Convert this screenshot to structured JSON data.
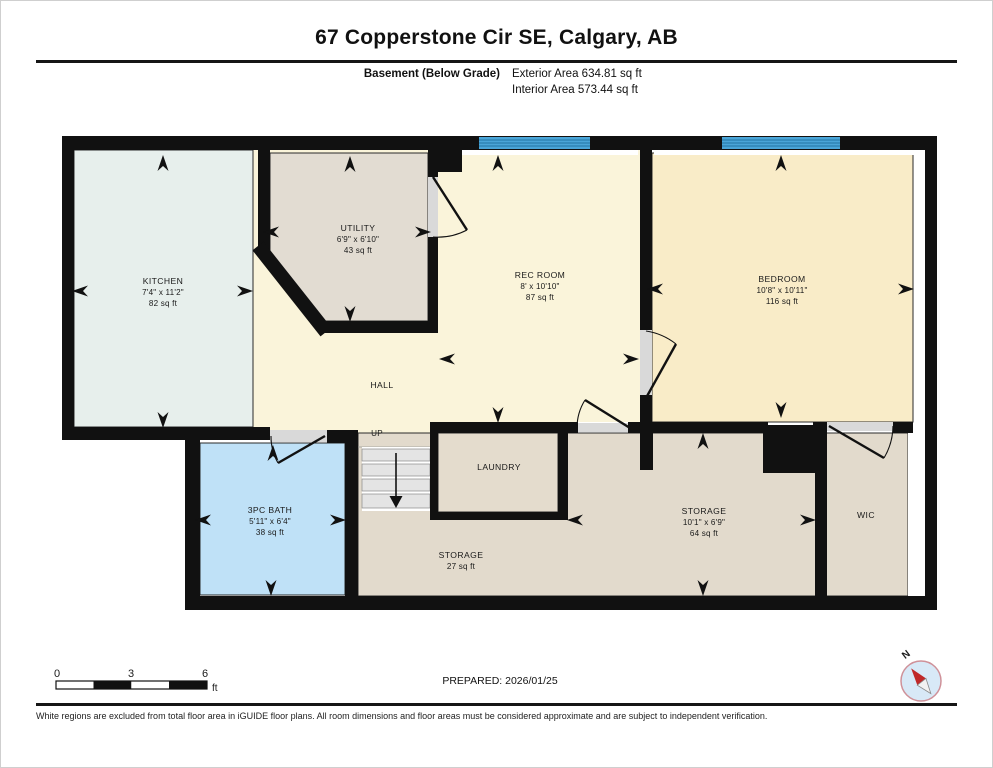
{
  "header": {
    "title": "67 Copperstone Cir SE, Calgary, AB",
    "floor_label": "Basement (Below Grade)",
    "exterior_area": "Exterior Area 634.81 sq ft",
    "interior_area": "Interior Area 573.44 sq ft"
  },
  "rooms": {
    "kitchen": {
      "name": "KITCHEN",
      "dims": "7'4\" x 11'2\"",
      "area": "82 sq ft"
    },
    "utility": {
      "name": "UTILITY",
      "dims": "6'9\" x 6'10\"",
      "area": "43 sq ft"
    },
    "rec_room": {
      "name": "REC ROOM",
      "dims": "8' x 10'10\"",
      "area": "87 sq ft"
    },
    "bedroom": {
      "name": "BEDROOM",
      "dims": "10'8\" x 10'11\"",
      "area": "116 sq ft"
    },
    "hall": {
      "name": "HALL"
    },
    "stairs": {
      "label": "UP"
    },
    "laundry": {
      "name": "LAUNDRY"
    },
    "bath": {
      "name": "3PC BATH",
      "dims": "5'11\" x 6'4\"",
      "area": "38 sq ft"
    },
    "storage_small": {
      "name": "STORAGE",
      "area": "27 sq ft"
    },
    "storage_large": {
      "name": "STORAGE",
      "dims": "10'1\" x 6'9\"",
      "area": "64 sq ft"
    },
    "wic": {
      "name": "WIC"
    }
  },
  "scale_bar": {
    "ticks": [
      "0",
      "3",
      "6"
    ],
    "unit": "ft"
  },
  "compass": {
    "label": "N"
  },
  "footer": {
    "prepared": "PREPARED: 2026/01/25",
    "disclaimer": "White regions are excluded from total floor area in iGUIDE floor plans. All room dimensions and floor areas must be considered approximate and are subject to independent verification."
  },
  "colors": {
    "wall": "#111111",
    "kitchen": "#e7efec",
    "utility": "#e2dcd2",
    "hall": "#faf4da",
    "bedroom": "#f9ecc8",
    "bath": "#bfe1f7",
    "storage": "#e2dacc",
    "laundry": "#e4dccd",
    "stairs": "#e4e4e4",
    "window": "#4aa5d8",
    "window_stripe": "#2b7fae",
    "door_sill": "#d9d9d9",
    "compass_ring": "#cf9199",
    "compass_fill": "#d8e9f7",
    "needle_red": "#c02828"
  }
}
